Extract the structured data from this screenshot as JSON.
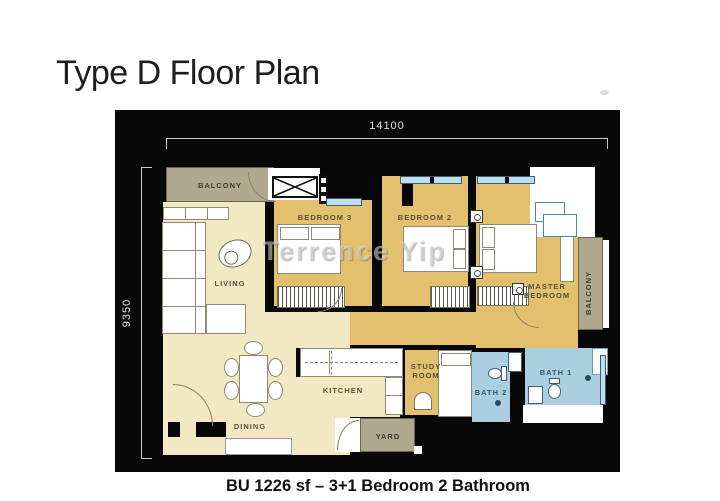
{
  "title": "Type D Floor Plan",
  "caption": "BU 1226 sf – 3+1 Bedroom 2 Bathroom",
  "watermark": "Terrence Yip",
  "dimensions": {
    "width_label": "14100",
    "height_label": "9350"
  },
  "rooms": {
    "balcony_top": "BALCONY",
    "living": "LIVING",
    "bedroom3": "BEDROOM 3",
    "bedroom2": "BEDROOM 2",
    "master_line1": "MASTER",
    "master_line2": "BEDROOM",
    "balcony_right": "BALCONY",
    "dining": "DINING",
    "kitchen": "KITCHEN",
    "study_line1": "STUDY",
    "study_line2": "ROOM",
    "bath1": "BATH 1",
    "bath2": "BATH 2",
    "yard": "YARD"
  },
  "colors": {
    "plan_background": "#080808",
    "floor_gold": "#e2c06e",
    "floor_cream": "#f3e8c4",
    "balcony_tan": "#b1a98e",
    "bath_blue": "#a9cfe1"
  }
}
